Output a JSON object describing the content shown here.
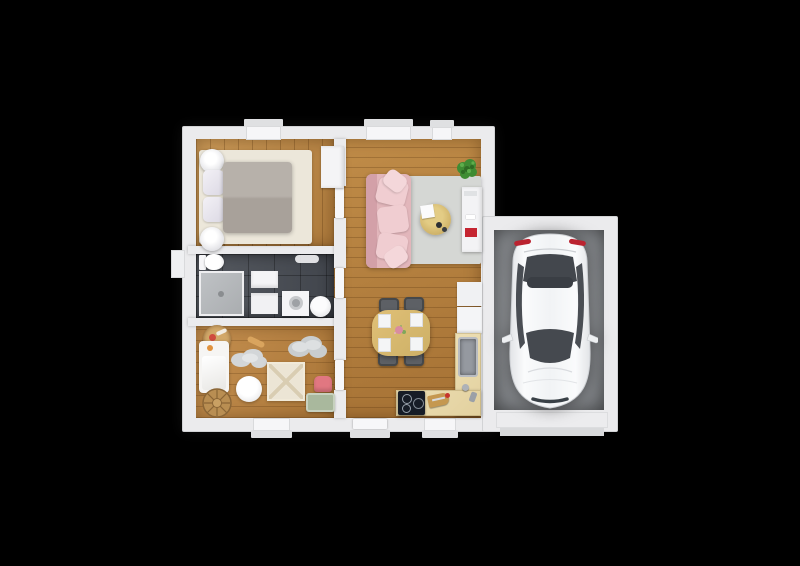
{
  "scene": {
    "type": "3d-floor-plan-render",
    "background": "#000000",
    "description": "Top-down 3D floor plan of a small house with attached single-car garage"
  },
  "palette": {
    "bg": "#000000",
    "wall": "#ebebed",
    "wall_edge": "#d2d3d5",
    "wood_bed_1": "#cb9a58",
    "wood_bed_2": "#ad7a3c",
    "wood_main_1": "#c08c48",
    "wood_main_2": "#a57134",
    "wood_kids_1": "#c48f4f",
    "wood_kids_2": "#aa7638",
    "tile": "#565a61",
    "tile_dark": "#41454c",
    "shower": "#b6b9bc",
    "garage_1": "#b2b5b8",
    "garage_2": "#707376",
    "rug": "#d5d7d4",
    "bed_rug": "#ece7da",
    "blanket": "#b1aaa3",
    "sofa": "#e2b6bb",
    "sofa_dark": "#d3a0a8",
    "sofa_light": "#f0cdd1",
    "counter": "#e2d09e",
    "table_wood": "#cdb066",
    "chair": "#5d6065",
    "red": "#c52531",
    "cooktop": "#161c26",
    "kid_pink": "#e17781",
    "kid_sage": "#a9b89d",
    "basket": "#bc8f52",
    "car_white": "#f4f5f7",
    "glass": "#43474d",
    "plant": "#3f8c33"
  },
  "rooms": [
    {
      "id": "bedroom",
      "label": "Bedroom",
      "floor": "wood"
    },
    {
      "id": "bathroom",
      "label": "Bathroom",
      "floor": "dark tile"
    },
    {
      "id": "kids-room",
      "label": "Kids room",
      "floor": "wood"
    },
    {
      "id": "living-dining-kitchen",
      "label": "Open living / dining / kitchen",
      "floor": "wood"
    },
    {
      "id": "garage",
      "label": "Garage",
      "floor": "concrete"
    }
  ],
  "furniture": {
    "bedroom": [
      "double-bed",
      "gray-blanket",
      "pillows",
      "bedside-lamp-left-top",
      "bedside-lamp-left-bottom",
      "cream-rug",
      "wardrobe"
    ],
    "bathroom": [
      "toilet",
      "walk-in-shower",
      "vanity-sink",
      "cabinet",
      "washing-machine",
      "laundry-basket",
      "bath-mat"
    ],
    "kids_room": [
      "toddler-bed",
      "toy-basket",
      "woven-basket",
      "cloud-rug-large",
      "cloud-rug-small",
      "play-mat",
      "kids-table",
      "pink-kids-chair",
      "toy-chest",
      "toy-rolling-pin"
    ],
    "living_dining_kitchen": [
      "pink-sofa",
      "gray-area-rug",
      "round-coffee-table",
      "note-card",
      "potted-plant",
      "tv-sideboard",
      "red-media-box",
      "dining-table",
      "dining-chairs-x4",
      "placemats-x4",
      "refrigerator",
      "upper-cabinet",
      "l-shaped-counter",
      "kitchen-sink",
      "faucet",
      "cooktop",
      "cutting-board"
    ],
    "garage": [
      "white-car"
    ]
  },
  "openings": {
    "windows_top": 3,
    "windows_bottom": 2,
    "window_left": 1,
    "front_door": 1,
    "interior_doors": 3,
    "garage_door": 1
  }
}
